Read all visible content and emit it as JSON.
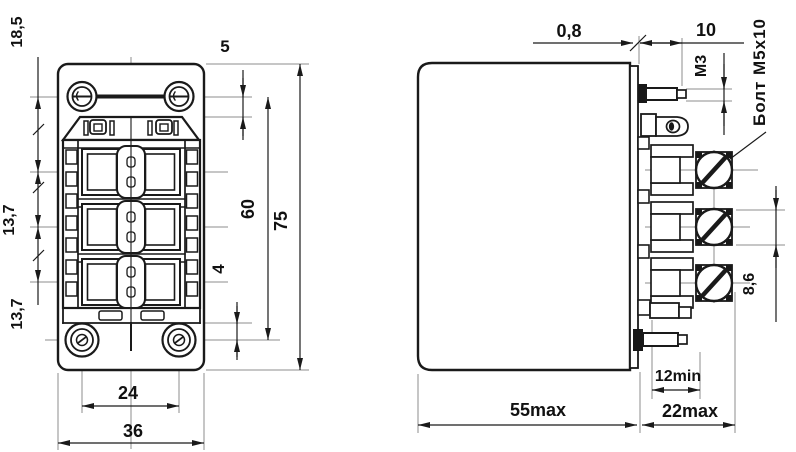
{
  "colors": {
    "line": "#1a1a1a",
    "thin_line": "#8c8c8c",
    "background": "#ffffff",
    "dark_fill": "#181818"
  },
  "front_view": {
    "name": "relay front view",
    "dims": {
      "top_to_row1": "18,5",
      "row_pitch_a": "13,7",
      "row_pitch_b": "13,7",
      "edge_to_screw": "5",
      "screw_span": "60",
      "overall_height": "75",
      "slot_offset": "4",
      "hole_span": "24",
      "overall_width": "36"
    }
  },
  "side_view": {
    "name": "relay side view",
    "dims": {
      "blade_thickness": "0,8",
      "tab_length": "10",
      "tab_thread": "M3",
      "screw_head": "8,6",
      "terminal_min": "12min",
      "body_depth": "55max",
      "terminal_depth": "22max"
    },
    "callout_bolt": "Болт M5x10"
  }
}
